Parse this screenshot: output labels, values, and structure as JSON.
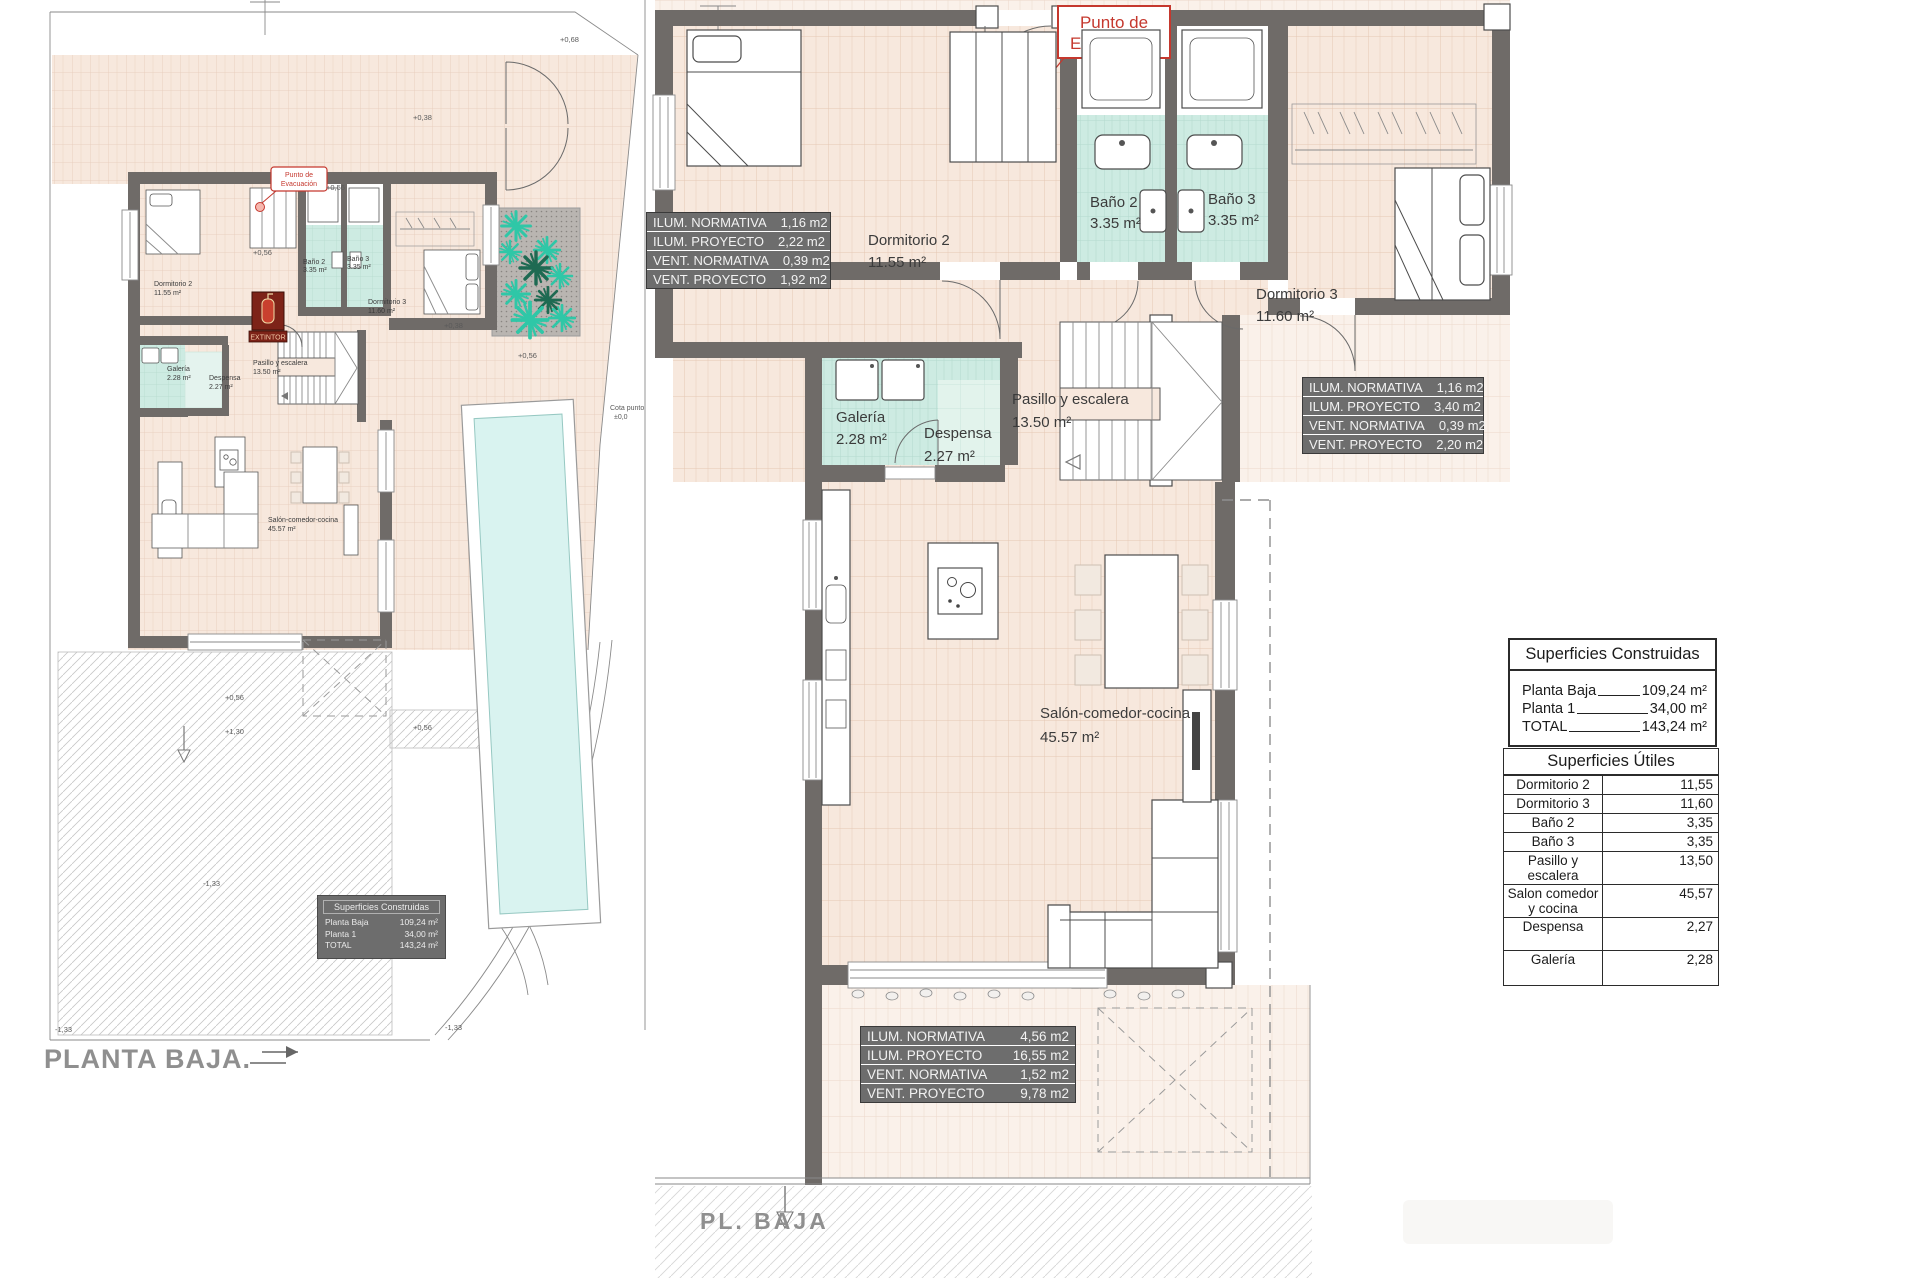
{
  "plans": {
    "left_title": "PLANTA BAJA.",
    "right_title": "PL. BAJA"
  },
  "rooms": {
    "dorm2": [
      "Dormitorio 2",
      "11.55 m²"
    ],
    "bano2": [
      "Baño 2",
      "3.35 m²"
    ],
    "bano3": [
      "Baño 3",
      "3.35 m²"
    ],
    "dorm3": [
      "Dormitorio 3",
      "11.60 m²"
    ],
    "galeria": [
      "Galería",
      "2.28 m²"
    ],
    "despensa": [
      "Despensa",
      "2.27 m²"
    ],
    "pasillo": [
      "Pasillo y escalera",
      "13.50 m²"
    ],
    "salon": [
      "Salón-comedor-cocina",
      "45.57 m²"
    ]
  },
  "evacuation": {
    "line1": "Punto de",
    "line2": "Evacuación"
  },
  "extintor": "EXTINTOR",
  "elevations": {
    "p068": "+0,68",
    "p038a": "+0,38",
    "p056a": "+0,56",
    "p056b": "+0,56",
    "p038b": "+0,38",
    "p056c": "+0,56",
    "p056d": "+0,56",
    "p130": "+1,30",
    "p056e": "+0,56",
    "m133a": "-1,33",
    "m133b": "-1,33",
    "m133c": "-1,33",
    "cota1": "Cota punto",
    "cota2": "±0,0"
  },
  "vent_tables": {
    "t1": {
      "rows": [
        [
          "ILUM. NORMATIVA",
          "1,16 m2"
        ],
        [
          "ILUM. PROYECTO",
          "2,22 m2"
        ],
        [
          "VENT. NORMATIVA",
          "0,39 m2"
        ],
        [
          "VENT. PROYECTO",
          "1,92 m2"
        ]
      ]
    },
    "t2": {
      "rows": [
        [
          "ILUM. NORMATIVA",
          "1,16 m2"
        ],
        [
          "ILUM. PROYECTO",
          "3,40 m2"
        ],
        [
          "VENT. NORMATIVA",
          "0,39 m2"
        ],
        [
          "VENT. PROYECTO",
          "2,20 m2"
        ]
      ]
    },
    "t3": {
      "rows": [
        [
          "ILUM. NORMATIVA",
          "4,56 m2"
        ],
        [
          "ILUM. PROYECTO",
          "16,55 m2"
        ],
        [
          "VENT. NORMATIVA",
          "1,52 m2"
        ],
        [
          "VENT. PROYECTO",
          "9,78 m2"
        ]
      ]
    }
  },
  "summary_construidas": {
    "title": "Superficies Construidas",
    "rows": [
      [
        "Planta Baja",
        "109,24 m²"
      ],
      [
        "Planta 1",
        "34,00 m²"
      ],
      [
        "TOTAL",
        "143,24 m²"
      ]
    ]
  },
  "summary_utiles": {
    "title": "Superficies Útiles",
    "rows": [
      [
        "Dormitorio 2",
        "11,55"
      ],
      [
        "Dormitorio 3",
        "11,60"
      ],
      [
        "Baño 2",
        "3,35"
      ],
      [
        "Baño 3",
        "3,35"
      ],
      [
        "Pasillo y escalera",
        "13,50"
      ],
      [
        "Salon comedor y cocina",
        "45,57"
      ],
      [
        "Despensa",
        "2,27"
      ],
      [
        "Galería",
        "2,28"
      ]
    ]
  },
  "colors": {
    "wall": "#6f6b68",
    "tile": "#f7e8dd",
    "teal": "#cdebe2",
    "red": "#c5382e",
    "pool": "#d9f3f0",
    "table_bg": "#6d6d6d"
  }
}
